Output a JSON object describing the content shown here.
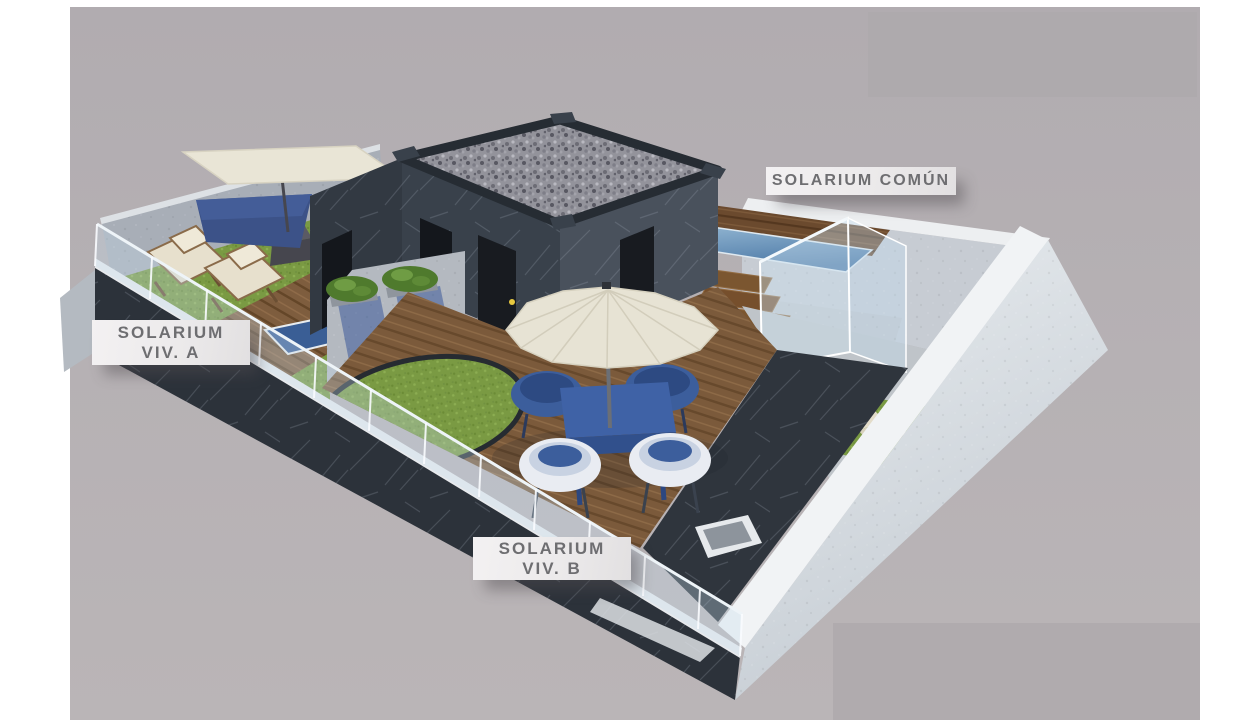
{
  "canvas": {
    "width_px": 1240,
    "height_px": 720,
    "margin_color": "#ffffff",
    "photo_background": "#b5afb2"
  },
  "render": {
    "kind": "3d-architectural-rooftop-render",
    "areas": [
      "solarium-viv-a",
      "solarium-viv-b",
      "solarium-comun"
    ]
  },
  "labels": {
    "comun": {
      "text": "SOLARIUM COMÚN"
    },
    "viv_a": {
      "line1": "SOLARIUM",
      "line2": "VIV. A"
    },
    "viv_b": {
      "line1": "SOLARIUM",
      "line2": "VIV. B"
    },
    "style": {
      "background": "#eceaeb",
      "text_color": "#6e6e71"
    }
  },
  "palette": {
    "slate_wall_dark": "#2c323a",
    "slate_wall_mid": "#39414b",
    "white_parapet": "#dde2e7",
    "plaster_wall": "#c7ccd3",
    "wood_deck": "#7b5a3b",
    "wood_pool_deck": "#6b4a2e",
    "grass": "#7a9a43",
    "pool_water": "#5d89b4",
    "furniture_blue": "#3d5d9e",
    "canvas_cream": "#e8e4d5",
    "glass_tint": "#cfe2ef",
    "gravel_roof": "#93939b",
    "label_text": "#6e6e71"
  },
  "objects": [
    "perimeter-white-wall",
    "front-slate-wall",
    "glass-balustrade",
    "stairwell-box",
    "gravel-roof",
    "roof-doors",
    "shade-sail",
    "hammock-sail",
    "deck-chairs",
    "umbrella-planter",
    "plunge-pool-viv-a",
    "planter-divider-wall",
    "grass-circle",
    "wood-deck-viv-b",
    "parasol",
    "dining-table",
    "dining-chairs",
    "raised-pool",
    "pool-wood-surround",
    "pool-steps",
    "pool-glass-screen",
    "common-grass",
    "sun-loungers",
    "corner-planter-slot"
  ]
}
